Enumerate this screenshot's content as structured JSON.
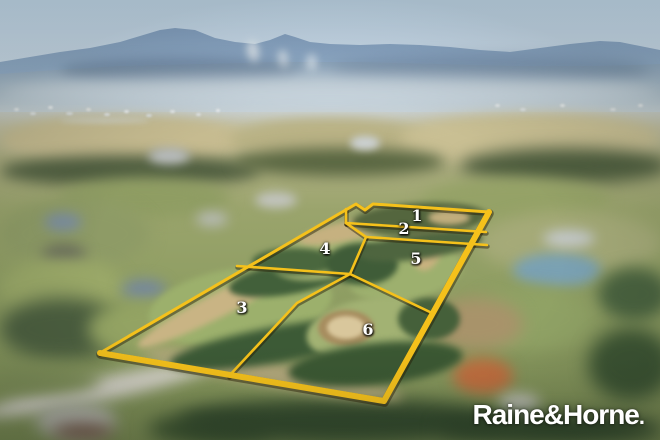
{
  "branding": {
    "agency_wordmark": "Raine&Horne",
    "wordmark_suffix": "."
  },
  "lots": [
    {
      "label": "1"
    },
    {
      "label": "2"
    },
    {
      "label": "3"
    },
    {
      "label": "4"
    },
    {
      "label": "5"
    },
    {
      "label": "6"
    }
  ],
  "colors": {
    "boundary_gold": "#F5C11B",
    "boundary_shadow": "rgba(35,24,0,0.45)",
    "wordmark_white": "#FFFFFF"
  }
}
